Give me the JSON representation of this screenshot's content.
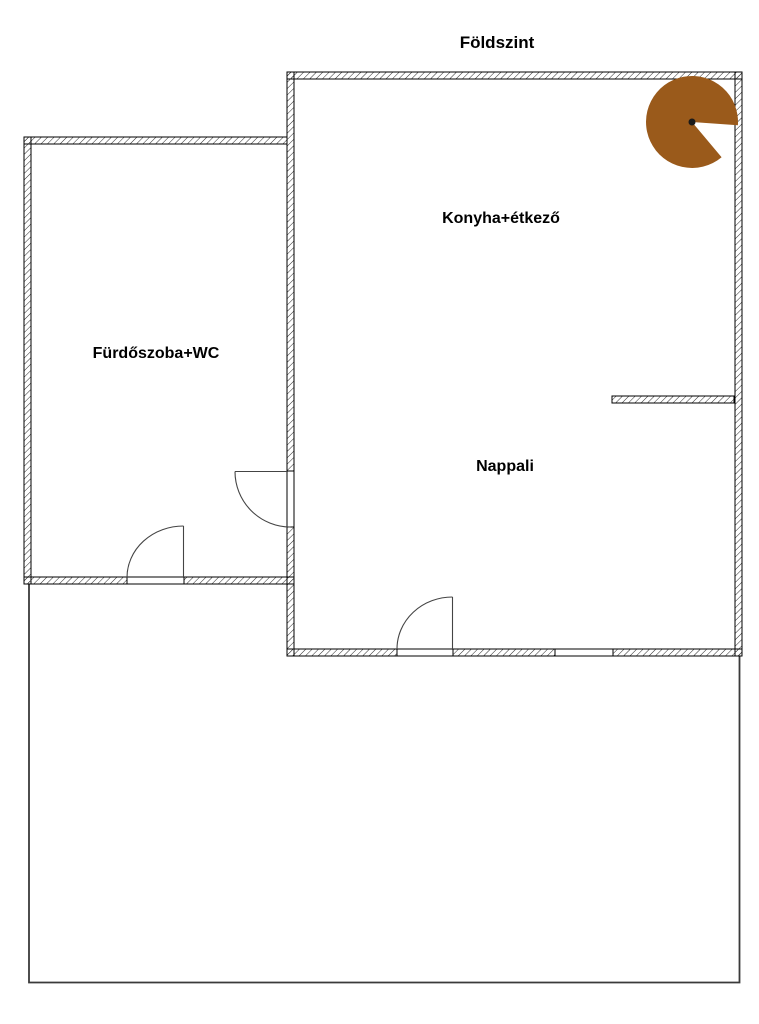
{
  "title": "Földszint",
  "rooms": [
    {
      "id": "konyha",
      "label": "Konyha+étkező"
    },
    {
      "id": "furdoszoba",
      "label": "Fürdőszoba+WC"
    },
    {
      "id": "nappali",
      "label": "Nappali"
    }
  ],
  "symbols": {
    "spiral_stair": "spiral-staircase",
    "spiral_stair_color": "#9A5A1B",
    "spiral_stair_dot_color": "#1a1a1a"
  },
  "colors": {
    "wall_outline": "#000000",
    "wall_hatch": "#2b2b2b",
    "terrace_outline": "#3a3a3a",
    "background": "#ffffff"
  }
}
